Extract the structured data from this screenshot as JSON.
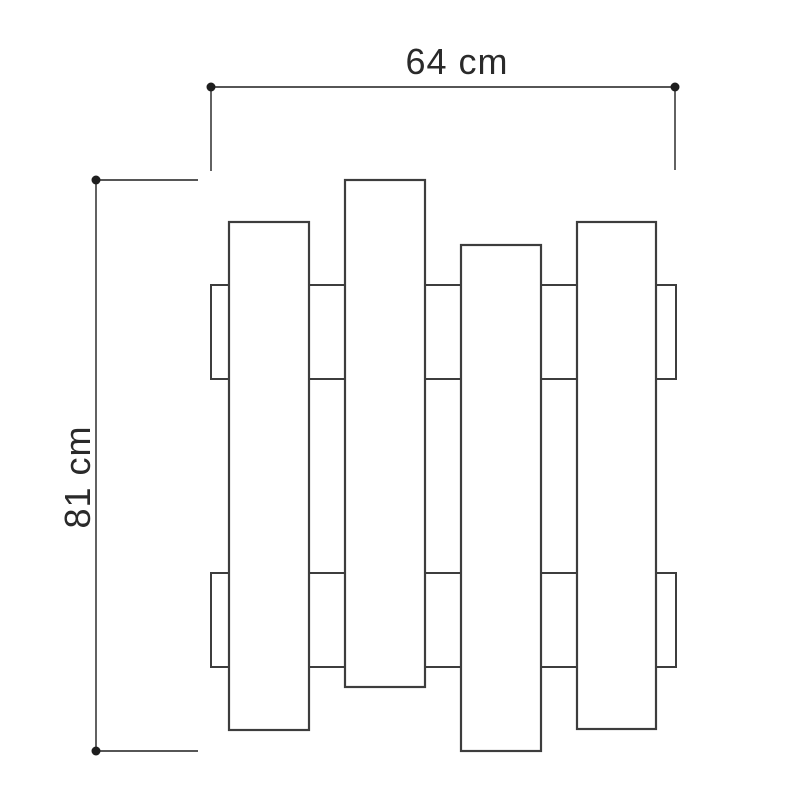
{
  "canvas": {
    "width": 800,
    "height": 800,
    "background": "#ffffff"
  },
  "style": {
    "shape_stroke": "#3d3d3d",
    "shape_fill": "#ffffff",
    "slat_stroke_width": 2.2,
    "rail_stroke_width": 2,
    "dimension_stroke": "#1e1e1e",
    "dimension_stroke_width": 1.4,
    "endpoint_radius": 4.5,
    "label_color": "#2a2a2a"
  },
  "drawing": {
    "rails": [
      {
        "x": 211,
        "y": 285,
        "width": 465,
        "height": 94
      },
      {
        "x": 211,
        "y": 573,
        "width": 465,
        "height": 94
      }
    ],
    "slats": [
      {
        "x": 229,
        "y": 222,
        "width": 80,
        "height": 508
      },
      {
        "x": 345,
        "y": 180,
        "width": 80,
        "height": 507
      },
      {
        "x": 461,
        "y": 245,
        "width": 80,
        "height": 506
      },
      {
        "x": 577,
        "y": 222,
        "width": 79,
        "height": 507
      }
    ]
  },
  "dimensions": {
    "width": {
      "label": "64 cm",
      "line": {
        "x1": 211,
        "y1": 87,
        "x2": 675,
        "y2": 87
      },
      "extensions": [
        {
          "x1": 211,
          "y1": 87,
          "x2": 211,
          "y2": 171
        },
        {
          "x1": 675,
          "y1": 87,
          "x2": 675,
          "y2": 170
        }
      ],
      "endpoints": [
        {
          "x": 211,
          "y": 87
        },
        {
          "x": 675,
          "y": 87
        }
      ]
    },
    "height": {
      "label": "81 cm",
      "line": {
        "x1": 96,
        "y1": 180,
        "x2": 96,
        "y2": 751
      },
      "extensions": [
        {
          "x1": 96,
          "y1": 180,
          "x2": 198,
          "y2": 180
        },
        {
          "x1": 96,
          "y1": 751,
          "x2": 198,
          "y2": 751
        }
      ],
      "endpoints": [
        {
          "x": 96,
          "y": 180
        },
        {
          "x": 96,
          "y": 751
        }
      ]
    }
  }
}
